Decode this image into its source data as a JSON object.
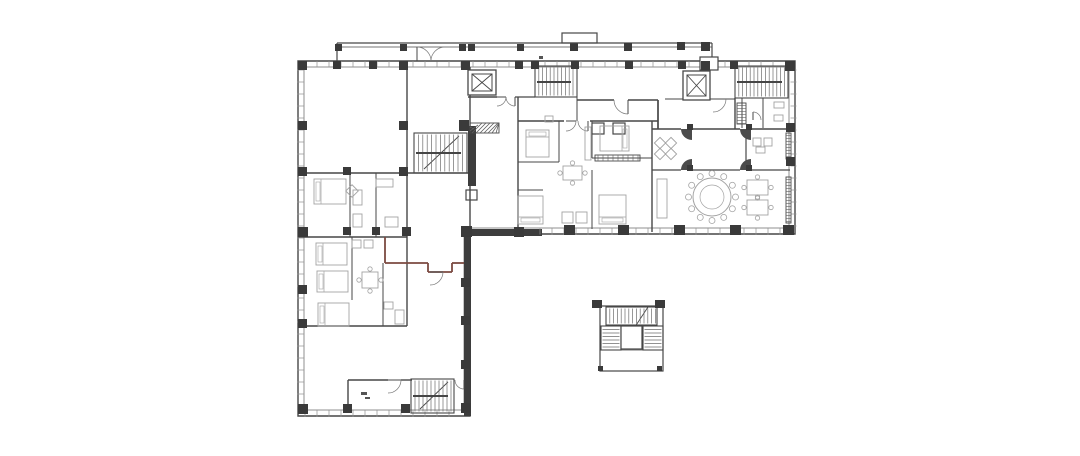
{
  "meta": {
    "type": "architectural-floor-plan",
    "description": "Black-and-white CAD floor plan of an L-shaped residential/hotel floor with stair cores, two elevators, apartment units, banquet room with round table, north canopy colonnade and a detached stair-tower detail",
    "canvas": {
      "width": 1080,
      "height": 456,
      "background": "#ffffff"
    }
  },
  "colors": {
    "wall": "#474747",
    "wallLight": "#8f8f8f",
    "column": "#3a3a3a",
    "furniture": "#a3a3a3",
    "accent": "#7b4a41",
    "hatch": "#5f5f5f",
    "tick": "#909090"
  },
  "outline": {
    "outer": "M298,61 H795 V234 H470 V416 H298 Z",
    "inner": "M304,67 H789 V228 H464 V410 H304 Z"
  },
  "canopy": {
    "lines": [
      [
        337,
        43,
        712,
        43,
        1.2
      ],
      [
        337,
        47,
        712,
        47,
        0.7
      ],
      [
        337,
        43,
        337,
        61,
        1.2
      ],
      [
        712,
        43,
        712,
        57,
        1.2
      ]
    ],
    "columns": [
      [
        335,
        44,
        7,
        7
      ],
      [
        400,
        44,
        7,
        7
      ],
      [
        459,
        44,
        7,
        7
      ],
      [
        468,
        44,
        7,
        7
      ],
      [
        517,
        44,
        7,
        7
      ],
      [
        570,
        43,
        8,
        8
      ],
      [
        624,
        43,
        8,
        8
      ],
      [
        677,
        42,
        8,
        8
      ],
      [
        701,
        42,
        9,
        9
      ]
    ]
  },
  "walls": [
    [
      407,
      61,
      407,
      173,
      1.4,
      0
    ],
    [
      298,
      173,
      470,
      173,
      1.4,
      0
    ],
    [
      470,
      67,
      470,
      229,
      1.4,
      0
    ],
    [
      518,
      97,
      518,
      229,
      1.4,
      0
    ],
    [
      468,
      97,
      497,
      97,
      1.4,
      0
    ],
    [
      515,
      97,
      535,
      97,
      1.2,
      0
    ],
    [
      577,
      97,
      577,
      121,
      1,
      0
    ],
    [
      518,
      121,
      564,
      121,
      1.4,
      0
    ],
    [
      590,
      121,
      658,
      121,
      1.4,
      0
    ],
    [
      577,
      100,
      614,
      100,
      1.4,
      0
    ],
    [
      628,
      100,
      658,
      100,
      1.4,
      0
    ],
    [
      658,
      100,
      658,
      129,
      1.7,
      0
    ],
    [
      665,
      99,
      683,
      99,
      1,
      0
    ],
    [
      710,
      99,
      713,
      99,
      1,
      0
    ],
    [
      726,
      99,
      735,
      99,
      1,
      0
    ],
    [
      735,
      98,
      735,
      129,
      1.4,
      0
    ],
    [
      652,
      121,
      652,
      232,
      1.4,
      0
    ],
    [
      652,
      129,
      681,
      129,
      1.4,
      0
    ],
    [
      692,
      129,
      740,
      129,
      1.4,
      0
    ],
    [
      751,
      129,
      790,
      129,
      1.4,
      0
    ],
    [
      746,
      129,
      746,
      170,
      1.2,
      0
    ],
    [
      652,
      170,
      681,
      170,
      1.2,
      0
    ],
    [
      692,
      170,
      740,
      170,
      1.2,
      0
    ],
    [
      751,
      170,
      790,
      170,
      1.2,
      0
    ],
    [
      763,
      98,
      763,
      128,
      1,
      0
    ],
    [
      742,
      98,
      742,
      128,
      1,
      0
    ],
    [
      559,
      121,
      559,
      162,
      1,
      0
    ],
    [
      518,
      162,
      559,
      162,
      1,
      0
    ],
    [
      518,
      190,
      543,
      190,
      1,
      0
    ],
    [
      592,
      121,
      592,
      158,
      1,
      0
    ],
    [
      592,
      170,
      592,
      229,
      1,
      0
    ],
    [
      592,
      158,
      652,
      158,
      1,
      0
    ],
    [
      350,
      173,
      350,
      237,
      1,
      0
    ],
    [
      376,
      173,
      376,
      237,
      1,
      0
    ],
    [
      298,
      237,
      407,
      237,
      1.4,
      0
    ],
    [
      352,
      237,
      352,
      300,
      1,
      0
    ],
    [
      383,
      263,
      383,
      326,
      1,
      0
    ],
    [
      298,
      326,
      407,
      326,
      1.4,
      0
    ],
    [
      407,
      173,
      407,
      326,
      1.4,
      0
    ],
    [
      385,
      237,
      385,
      263,
      1.8,
      1
    ],
    [
      385,
      263,
      428,
      263,
      1.8,
      1
    ],
    [
      452,
      263,
      467,
      263,
      1.8,
      1
    ],
    [
      428,
      263,
      428,
      272,
      1.8,
      1
    ],
    [
      428,
      272,
      452,
      272,
      1.8,
      1
    ],
    [
      452,
      272,
      452,
      263,
      1.8,
      1
    ],
    [
      348,
      380,
      388,
      380,
      1.4,
      0
    ],
    [
      401,
      380,
      412,
      380,
      1.4,
      0
    ],
    [
      464,
      380,
      467,
      380,
      1.4,
      0
    ],
    [
      348,
      380,
      348,
      413,
      1.4,
      0
    ],
    [
      459,
      136,
      424,
      169,
      0.9,
      0
    ],
    [
      448,
      382,
      420,
      409,
      0.9,
      0
    ],
    [
      648,
      307,
      623,
      345,
      0.9,
      0
    ],
    [
      601,
      350,
      662,
      350,
      0.8,
      0
    ]
  ],
  "darkRects": [
    [
      468,
      126,
      8,
      60
    ],
    [
      462,
      229,
      80,
      7
    ],
    [
      464,
      234,
      7,
      182
    ]
  ],
  "columns": [
    [
      298,
      61,
      9,
      9
    ],
    [
      333,
      61,
      8,
      8
    ],
    [
      369,
      61,
      8,
      8
    ],
    [
      399,
      61,
      9,
      9
    ],
    [
      461,
      61,
      9,
      9
    ],
    [
      515,
      61,
      8,
      8
    ],
    [
      531,
      61,
      8,
      8
    ],
    [
      571,
      61,
      8,
      8
    ],
    [
      625,
      61,
      8,
      8
    ],
    [
      678,
      61,
      8,
      8
    ],
    [
      701,
      61,
      9,
      9
    ],
    [
      730,
      61,
      8,
      8
    ],
    [
      785,
      61,
      10,
      10
    ],
    [
      298,
      121,
      9,
      9
    ],
    [
      298,
      167,
      9,
      9
    ],
    [
      298,
      227,
      10,
      10
    ],
    [
      298,
      285,
      9,
      9
    ],
    [
      298,
      319,
      9,
      9
    ],
    [
      298,
      404,
      10,
      10
    ],
    [
      399,
      121,
      9,
      9
    ],
    [
      399,
      167,
      9,
      9
    ],
    [
      343,
      167,
      8,
      8
    ],
    [
      343,
      227,
      8,
      8
    ],
    [
      372,
      227,
      8,
      8
    ],
    [
      402,
      227,
      9,
      9
    ],
    [
      461,
      226,
      11,
      11
    ],
    [
      514,
      227,
      10,
      10
    ],
    [
      564,
      225,
      11,
      10
    ],
    [
      618,
      225,
      11,
      10
    ],
    [
      674,
      225,
      11,
      10
    ],
    [
      730,
      225,
      11,
      10
    ],
    [
      783,
      225,
      11,
      10
    ],
    [
      786,
      123,
      9,
      9
    ],
    [
      786,
      157,
      9,
      9
    ],
    [
      461,
      278,
      9,
      9
    ],
    [
      461,
      316,
      9,
      9
    ],
    [
      461,
      360,
      9,
      9
    ],
    [
      461,
      403,
      10,
      10
    ],
    [
      343,
      404,
      9,
      9
    ],
    [
      401,
      404,
      9,
      9
    ],
    [
      459,
      120,
      10,
      11
    ],
    [
      592,
      300,
      10,
      8
    ],
    [
      655,
      300,
      10,
      8
    ],
    [
      598,
      366,
      5,
      5
    ],
    [
      657,
      366,
      5,
      5
    ],
    [
      687,
      124,
      6,
      6
    ],
    [
      746,
      124,
      6,
      6
    ],
    [
      687,
      165,
      6,
      6
    ],
    [
      746,
      165,
      6,
      6
    ]
  ],
  "windowTicks": [
    [
      305,
      64,
      784,
      64
    ],
    [
      300.5,
      70,
      300.5,
      404
    ],
    [
      305,
      413.5,
      460,
      413.5
    ],
    [
      540,
      231.5,
      782,
      231.5
    ],
    [
      793.5,
      70,
      793.5,
      226
    ]
  ],
  "stairs": [
    {
      "x": 414,
      "y": 133,
      "w": 53,
      "h": 40,
      "dir": "v",
      "step": 4.4,
      "rail": 153
    },
    {
      "x": 535,
      "y": 66,
      "w": 42,
      "h": 31,
      "dir": "v",
      "step": 3.8,
      "rail": 82
    },
    {
      "x": 735,
      "y": 66,
      "w": 53,
      "h": 32,
      "dir": "v",
      "step": 3.8,
      "rail": 82
    },
    {
      "x": 411,
      "y": 379,
      "w": 43,
      "h": 34,
      "dir": "v",
      "step": 4,
      "rail": 396
    },
    {
      "x": 606,
      "y": 307,
      "w": 51,
      "h": 18,
      "dir": "v",
      "step": 3.8,
      "rail": 0
    },
    {
      "x": 601,
      "y": 326,
      "w": 20,
      "h": 24,
      "dir": "h",
      "step": 3.5,
      "rail": 0
    },
    {
      "x": 643,
      "y": 326,
      "w": 20,
      "h": 24,
      "dir": "h",
      "step": 3.5,
      "rail": 0
    }
  ],
  "elevators": [
    [
      468,
      70,
      28,
      25
    ],
    [
      683,
      71,
      27,
      29
    ]
  ],
  "doors": [
    {
      "c": [
        417,
        61
      ],
      "r": 14,
      "a": [
        270,
        360
      ],
      "f": 0
    },
    {
      "c": [
        445,
        61
      ],
      "r": 14,
      "a": [
        180,
        270
      ],
      "f": 0
    },
    {
      "c": [
        497,
        97
      ],
      "r": 9,
      "a": [
        0,
        90
      ],
      "f": 0
    },
    {
      "c": [
        515,
        97
      ],
      "r": 9,
      "a": [
        90,
        180
      ],
      "f": 0
    },
    {
      "c": [
        628,
        100
      ],
      "r": 14,
      "a": [
        90,
        180
      ],
      "f": 0
    },
    {
      "c": [
        566,
        121
      ],
      "r": 10,
      "a": [
        0,
        90
      ],
      "f": 0
    },
    {
      "c": [
        588,
        121
      ],
      "r": 10,
      "a": [
        90,
        180
      ],
      "f": 0
    },
    {
      "c": [
        692,
        129
      ],
      "r": 11,
      "a": [
        90,
        180
      ],
      "f": 1
    },
    {
      "c": [
        751,
        129
      ],
      "r": 11,
      "a": [
        90,
        180
      ],
      "f": 1
    },
    {
      "c": [
        692,
        170
      ],
      "r": 11,
      "a": [
        180,
        270
      ],
      "f": 1
    },
    {
      "c": [
        751,
        170
      ],
      "r": 11,
      "a": [
        180,
        270
      ],
      "f": 1
    },
    {
      "c": [
        430,
        272
      ],
      "r": 13,
      "a": [
        0,
        90
      ],
      "f": 0
    },
    {
      "c": [
        388,
        380
      ],
      "r": 13,
      "a": [
        0,
        90
      ],
      "f": 0
    },
    {
      "c": [
        464,
        380
      ],
      "r": 9,
      "a": [
        90,
        180
      ],
      "f": 0
    },
    {
      "c": [
        753,
        120
      ],
      "r": 8,
      "a": [
        270,
        360
      ],
      "f": 0
    },
    {
      "c": [
        713,
        99
      ],
      "r": 13,
      "a": [
        0,
        90
      ],
      "f": 0
    }
  ],
  "hatches": [
    {
      "x": 470,
      "y": 123,
      "w": 29,
      "h": 10,
      "t": "d"
    },
    {
      "x": 737,
      "y": 103,
      "w": 9,
      "h": 21,
      "t": "h"
    },
    {
      "x": 786,
      "y": 133,
      "w": 5,
      "h": 26,
      "t": "h"
    },
    {
      "x": 786,
      "y": 177,
      "w": 5,
      "h": 46,
      "t": "h"
    },
    {
      "x": 595,
      "y": 155,
      "w": 45,
      "h": 6,
      "t": "v"
    }
  ],
  "rects": [
    [
      600,
      306,
      63,
      65,
      0
    ],
    [
      621,
      326,
      21,
      23,
      1
    ],
    [
      562,
      33,
      35,
      10,
      0
    ],
    [
      700,
      57,
      18,
      13,
      1
    ],
    [
      466,
      190,
      11,
      10,
      0
    ],
    [
      592,
      123,
      12,
      11,
      0
    ],
    [
      613,
      123,
      12,
      11,
      0
    ]
  ],
  "furniture": {
    "beds": [
      [
        314,
        179,
        32,
        25,
        "W"
      ],
      [
        316,
        243,
        31,
        22,
        "W"
      ],
      [
        317,
        271,
        31,
        21,
        "W"
      ],
      [
        318,
        303,
        31,
        23,
        "W"
      ],
      [
        526,
        130,
        23,
        27,
        "N"
      ],
      [
        600,
        126,
        29,
        25,
        "E"
      ],
      [
        518,
        196,
        25,
        28,
        "S"
      ],
      [
        599,
        195,
        27,
        29,
        "S"
      ]
    ],
    "tablesWithChairs": [
      [
        362,
        272,
        16,
        16
      ],
      [
        563,
        166,
        19,
        14
      ],
      [
        747,
        180,
        21,
        15
      ],
      [
        747,
        200,
        21,
        15
      ]
    ],
    "diamonds": [
      [
        352,
        191,
        10
      ],
      [
        660,
        143,
        9
      ],
      [
        671,
        143,
        9
      ],
      [
        660,
        154,
        9
      ],
      [
        671,
        154,
        9
      ]
    ],
    "roundTable": {
      "cx": 712,
      "cy": 197,
      "r": 19,
      "chairs": 12
    },
    "smallRects": [
      [
        376,
        179,
        17,
        8
      ],
      [
        353,
        190,
        9,
        15
      ],
      [
        353,
        214,
        9,
        13
      ],
      [
        385,
        217,
        13,
        10
      ],
      [
        384,
        302,
        9,
        7
      ],
      [
        395,
        310,
        9,
        14
      ],
      [
        352,
        240,
        9,
        8
      ],
      [
        364,
        240,
        9,
        8
      ],
      [
        585,
        127,
        6,
        33
      ],
      [
        657,
        179,
        10,
        39
      ],
      [
        545,
        116,
        8,
        6
      ],
      [
        774,
        102,
        10,
        6
      ],
      [
        774,
        115,
        9,
        6
      ],
      [
        756,
        147,
        9,
        6
      ],
      [
        753,
        138,
        8,
        8
      ],
      [
        764,
        138,
        8,
        8
      ],
      [
        562,
        212,
        11,
        11
      ],
      [
        576,
        212,
        11,
        11
      ]
    ]
  },
  "marks": [
    [
      539,
      56,
      4,
      3
    ],
    [
      361,
      392,
      6,
      3
    ],
    [
      365,
      397,
      5,
      2
    ]
  ]
}
